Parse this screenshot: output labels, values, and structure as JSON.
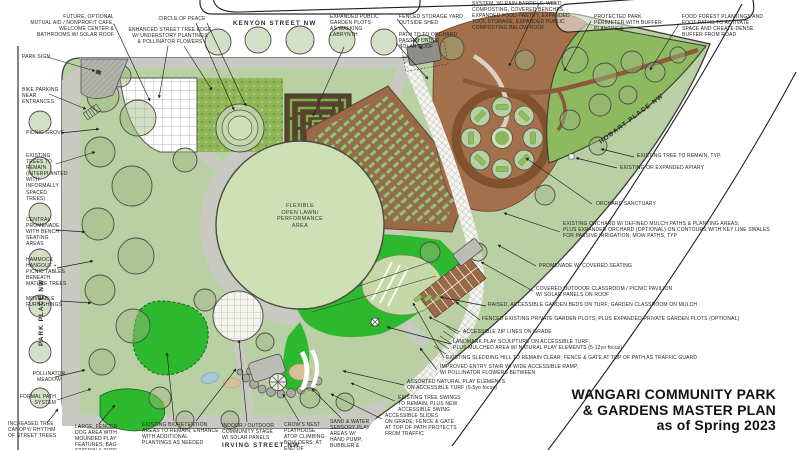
{
  "colors": {
    "park_green": "#b9cfa4",
    "turf_green": "#2db92d",
    "orchard_brown": "#9a6a48",
    "dark_brown": "#584230",
    "maze_green": "#7fae4e",
    "forest_green": "#8db95f",
    "path_gray": "#c8c9c2",
    "ink": "#1f1f1f",
    "label_ink": "#26261f"
  },
  "title_block": {
    "line1": "WANGARI COMMUNITY PARK",
    "line2": "& GARDENS MASTER PLAN",
    "line3": "as of Spring 2023"
  },
  "streets": {
    "north": "KENYON STREET NW",
    "east": "HOBART PLACE NW",
    "west": "PARK PLACE NW",
    "south": "IRVING STREET NW"
  },
  "plan": {
    "open_lawn_label": "FLEXIBLE\nOPEN LAWN/\nPERFORMANCE\nAREA"
  },
  "annotations": {
    "future_cafe": "FUTURE, OPTIONAL\nMUTUAL AID / NONPROFIT CAFE,\nWELCOME CENTER &\nBATHROOMS W/ SOLAR ROOF",
    "circle_of_peace": "CIRCLE OF PEACE",
    "street_tree_edge": "ENHANCED STREET TREE EDGE\nW/ UNDERSTORY PLANTINGS\n& POLLINATOR FLOWERS",
    "garden_labyrinth": "EXPANDED PUBLIC\nGARDEN PLOTS\nAS WALKING\nLABRYNTH",
    "storage_yard": "FENCED STORAGE YARD\nOUTSIDE SHED",
    "path_to_orchard": "PATH TO TO ORCHARD\nPASSES UNDER\nSOLAR ROOF",
    "farm_system": "SYSTEM, W/ RAIN BARRELS, WEED\nCOMPOSTING, COVERED BENCHES,\nEXPANDED FOOD PANTRY, EXPANDED\nTOOL STORAGE, EXPANDED PUBLIC\nCOMPOSTING BELOW ROOF",
    "protected_perimeter": "PROTECTED PARK\nPERIMETER WITH BUFFER\nPLANTINGS",
    "food_forest": "FOOD FOREST PLANTINGS AND\nFOOT PATHS TO ACTIVATE\nSPACE AND CREATE DENSE\nBUFFER FROM ROAD",
    "park_sign": "PARK SIGN",
    "bike_parking": "BIKE PARKING\nNEAR\nENTRANCES",
    "picnic_grove": "PICNIC GROVE",
    "existing_trees": "EXISTING\nTREES TO\nREMAIN\n(INTERPLANTED\nWITH\nINFORMALLY\nSPACED\nTREES)",
    "central_promenade": "CENTRAL\nPROMENADE\nWITH BENCH\nSEATING\nAREAS",
    "hammock_hangout": "HAMMOCK\nHANGOUT +\nPICNIC TABLES\nBENEATH\nMATURE TREES",
    "moveable_furnishings": "MOVEABLE\nFURNISHINGS",
    "pollinator_meadow": "POLLINATOR\nMEADOW",
    "formal_path": "FORMAL PATH\nSYSTEM",
    "increased_canopy": "INCREASED TREE\nCANOPY/ RHYTHM\nOF STREET TREES",
    "dog_area": "LARGE, FENCED\nDOG AREA WITH\nMOUNDED PLAY\nFEATURES, BAG\nSTATION & TURF",
    "bioretention": "EXISTING BIORETENTION\nAREAS TO REMAIN; ENHANCE\nWITH ADDITIONAL\nPLANTINGS AS NEEDED",
    "community_stage": "INDOOR / OUTDOOR\nCOMMUNITY STAGE\nW/ SOLAR PANELS",
    "crows_nest": "CROW'S NEST\nPLAYHOUSE\nATOP CLIMBING\nBOULDERS; AT\nEND OF",
    "sand_water": "SAND & WATER\nSENSORY PLAY\nAREAS W/\nHAND PUMP,\nBUBBLER &",
    "existing_tree_typ": "EXISTING TREE TO REMAIN, TYP.",
    "apiary": "EXISTING OR EXPANDED APIARY",
    "orchard_sanctuary": "ORCHARD SANCTUARY",
    "existing_orchard": "EXISTING ORCHARD W/ DEFINED MULCH PATHS & PLANTING AREAS;\nPLUS EXPANDED ORCHARD (OPTIONAL) ON CONTOURS WITH KEY LINE SWALES\nFOR PASSIVE IRRIGATION; MOW PATHS, TYP",
    "promenade_seating": "PROMENADE W/ COVERED SEATING",
    "outdoor_classroom": "COVERED OUTDOOR CLASSROOM / PICNIC PAVILION\nW/ SOLAR PANELS ON ROOF",
    "raised_beds": "RAISED, ACCESSIBLE GARDEN BEDS ON  TURF; GARDEN CLASSROOM ON MULCH",
    "private_plots": "FENCED EXISTING PRIVATE GARDEN PLOTS, PLUS EXPANDED PRIVATE GARDEN PLOTS (OPTIONAL)",
    "zip_lines": "ACCESSIBLE ZIP LINES ON GRADE",
    "play_sculpture": "LANDMARK PLAY SCULPTURE ON ACCESSIBLE TURF;\nPLUS MULCHED AREA W/ NATURAL PLAY ELEMENTS (5-12yo focus)",
    "sledding_hill": "EXISTING SLEDDING HILL TO REMAIN CLEAR; FENCE & GATE AT TOP OF PATH AS TRAFFIC GUARD",
    "entry_stair": "IMPROVED ENTRY STAIR W/ WIDE ACCESSIBLE RAMP,\nW/ POLLINATOR FLOWERS BETWEEN",
    "natural_play": "ASSORTED NATURAL PLAY ELEMENTS\nON ACCESSIBLE TURF (0-5yo focus)",
    "tree_swings": "EXISTING TREE SWINGS\nTO REMAIN, PLUS NEW\nACCESSIBLE SWING",
    "slides": "ACCESSIBLE SLIDES\nON GRADE; FENCE & GATE\nAT TOP OF PATH PROTECTS\nFROM TRAFFIC"
  }
}
